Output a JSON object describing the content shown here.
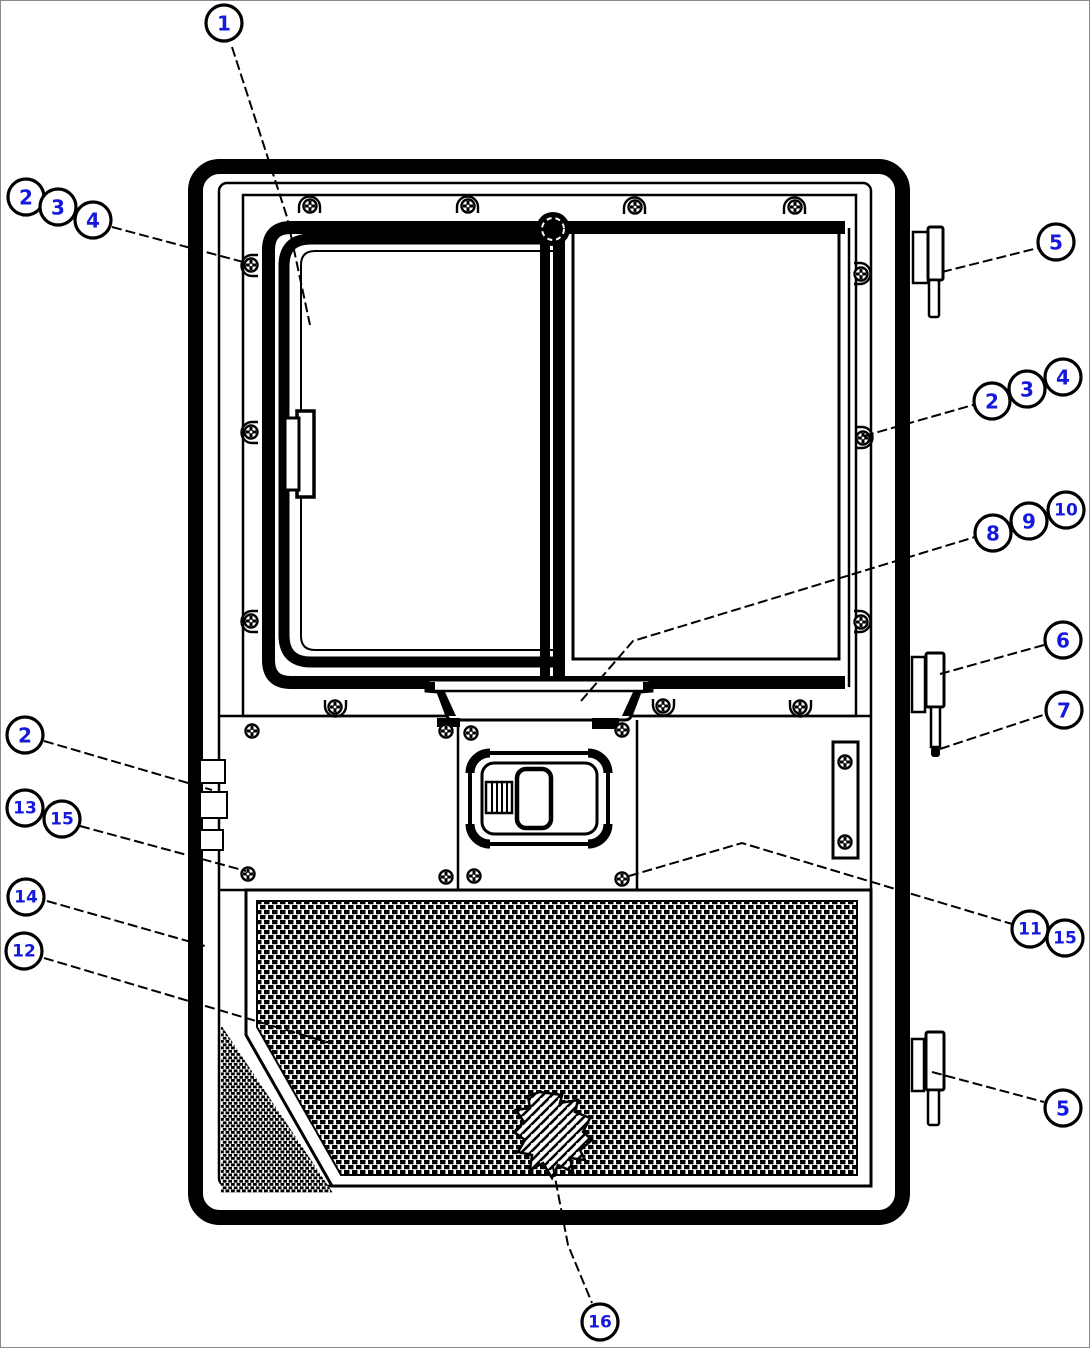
{
  "figure": {
    "type": "exploded-parts-diagram",
    "subject": "cab door assembly with sliding window, latch handle and mesh screen panel"
  },
  "colors": {
    "ink": "#000000",
    "paper": "#ffffff",
    "callout_number": "#1518dd",
    "canvas_border": "#8a8a8a"
  },
  "callouts": [
    {
      "label": "1",
      "x": 224,
      "y": 23
    },
    {
      "label": "2",
      "x": 26,
      "y": 197
    },
    {
      "label": "3",
      "x": 58,
      "y": 207
    },
    {
      "label": "4",
      "x": 93,
      "y": 220
    },
    {
      "label": "5",
      "x": 1056,
      "y": 242
    },
    {
      "label": "4",
      "x": 1063,
      "y": 377
    },
    {
      "label": "3",
      "x": 1027,
      "y": 389
    },
    {
      "label": "2",
      "x": 992,
      "y": 401
    },
    {
      "label": "10",
      "x": 1066,
      "y": 510
    },
    {
      "label": "9",
      "x": 1029,
      "y": 521
    },
    {
      "label": "8",
      "x": 993,
      "y": 533
    },
    {
      "label": "6",
      "x": 1063,
      "y": 640
    },
    {
      "label": "7",
      "x": 1064,
      "y": 710
    },
    {
      "label": "2",
      "x": 25,
      "y": 735
    },
    {
      "label": "13",
      "x": 25,
      "y": 808
    },
    {
      "label": "15",
      "x": 62,
      "y": 819
    },
    {
      "label": "14",
      "x": 26,
      "y": 897
    },
    {
      "label": "12",
      "x": 24,
      "y": 951
    },
    {
      "label": "15",
      "x": 1065,
      "y": 938
    },
    {
      "label": "11",
      "x": 1030,
      "y": 929
    },
    {
      "label": "5",
      "x": 1063,
      "y": 1108
    },
    {
      "label": "16",
      "x": 600,
      "y": 1322
    }
  ],
  "leaders": [
    {
      "points": [
        [
          232,
          47
        ],
        [
          287,
          217
        ],
        [
          310,
          325
        ]
      ]
    },
    {
      "points": [
        [
          112,
          227
        ],
        [
          247,
          263
        ]
      ]
    },
    {
      "points": [
        [
          942,
          272
        ],
        [
          1038,
          248
        ]
      ]
    },
    {
      "points": [
        [
          864,
          436
        ],
        [
          973,
          405
        ]
      ]
    },
    {
      "points": [
        [
          581,
          701
        ],
        [
          633,
          641
        ],
        [
          975,
          537
        ]
      ]
    },
    {
      "points": [
        [
          940,
          674
        ],
        [
          1044,
          645
        ]
      ]
    },
    {
      "points": [
        [
          940,
          749
        ],
        [
          1046,
          714
        ]
      ]
    },
    {
      "points": [
        [
          44,
          741
        ],
        [
          212,
          790
        ]
      ]
    },
    {
      "points": [
        [
          80,
          826
        ],
        [
          246,
          871
        ]
      ]
    },
    {
      "points": [
        [
          47,
          901
        ],
        [
          205,
          946
        ]
      ]
    },
    {
      "points": [
        [
          44,
          958
        ],
        [
          330,
          1043
        ]
      ]
    },
    {
      "points": [
        [
          629,
          876
        ],
        [
          742,
          843
        ],
        [
          1012,
          924
        ]
      ]
    },
    {
      "points": [
        [
          932,
          1072
        ],
        [
          1044,
          1102
        ]
      ]
    },
    {
      "points": [
        [
          553,
          1167
        ],
        [
          568,
          1245
        ],
        [
          592,
          1303
        ]
      ]
    }
  ],
  "hardware": {
    "screws": [
      [
        252,
        731
      ],
      [
        446,
        731
      ],
      [
        471,
        733
      ],
      [
        622,
        730
      ],
      [
        248,
        874
      ],
      [
        446,
        877
      ],
      [
        474,
        876
      ],
      [
        622,
        879
      ],
      [
        845,
        762
      ],
      [
        845,
        842
      ]
    ],
    "clip_screws": [
      {
        "x": 310,
        "y": 206,
        "rot": 0
      },
      {
        "x": 468,
        "y": 206,
        "rot": 0
      },
      {
        "x": 635,
        "y": 207,
        "rot": 0
      },
      {
        "x": 795,
        "y": 207,
        "rot": 0
      },
      {
        "x": 251,
        "y": 265,
        "rot": -90
      },
      {
        "x": 251,
        "y": 432,
        "rot": -90
      },
      {
        "x": 251,
        "y": 621,
        "rot": -90
      },
      {
        "x": 861,
        "y": 274,
        "rot": 90
      },
      {
        "x": 863,
        "y": 438,
        "rot": 90
      },
      {
        "x": 861,
        "y": 622,
        "rot": 90
      },
      {
        "x": 335,
        "y": 707,
        "rot": 180
      },
      {
        "x": 663,
        "y": 706,
        "rot": 180
      },
      {
        "x": 800,
        "y": 707,
        "rot": 180
      }
    ]
  }
}
